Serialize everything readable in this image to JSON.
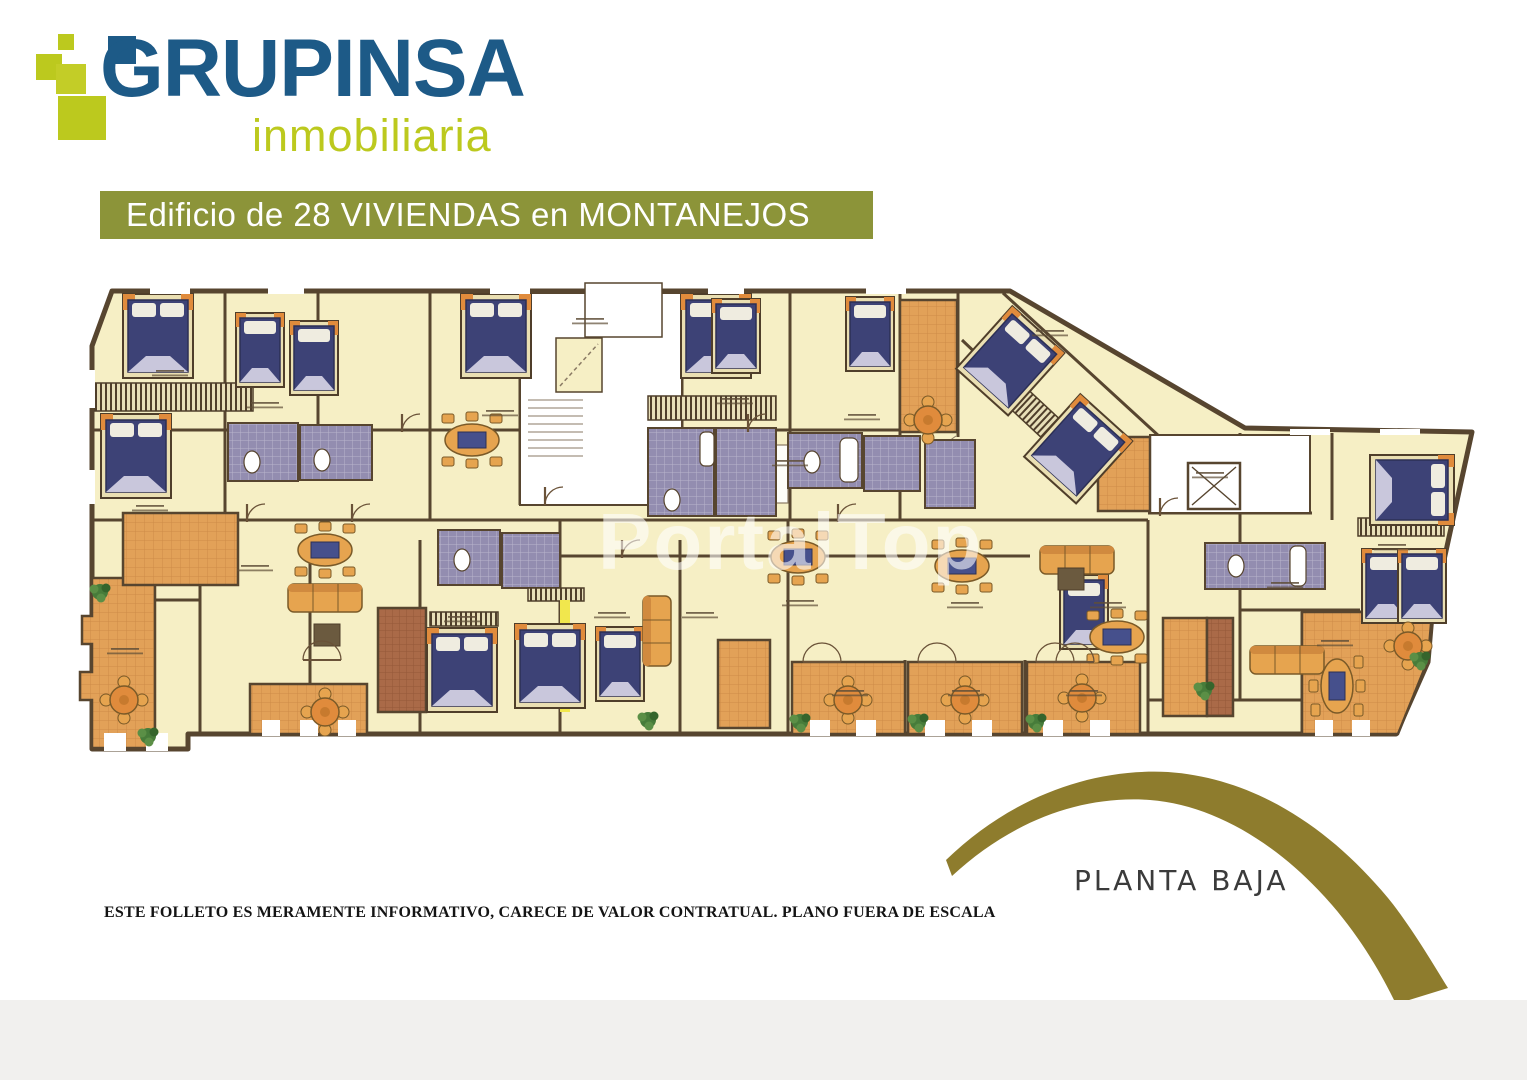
{
  "page": {
    "background": "#ffffff",
    "footer_band_color": "#f1f0ee"
  },
  "logo": {
    "wordmark": "GRUPINSA",
    "tagline": "inmobiliaria",
    "colors": {
      "blue": "#1d5a87",
      "green": "#bcc91e"
    }
  },
  "banner": {
    "label": "Edificio de 28 VIVIENDAS en MONTANEJOS",
    "bg": "#8c9439",
    "fg": "#ffffff"
  },
  "plan": {
    "watermark": "PortalTop",
    "caption": "PLANTA BAJA",
    "colors": {
      "room": "#f6efc5",
      "wall": "#57452f",
      "terrace_tile": "#e2a158",
      "dark_tile": "#aa6a48",
      "bed": "#3d4276",
      "bath_tile": "#938db0",
      "furniture": "#e6a44f",
      "plant": "#477c3a",
      "highlight_yellow": "#f1e74d",
      "core_white": "#ffffff"
    }
  },
  "decor": {
    "arc_color": "#8e7c2d"
  },
  "footer": {
    "disclaimer": "ESTE FOLLETO ES MERAMENTE INFORMATIVO, CARECE DE VALOR CONTRATUAL. PLANO FUERA DE ESCALA"
  }
}
